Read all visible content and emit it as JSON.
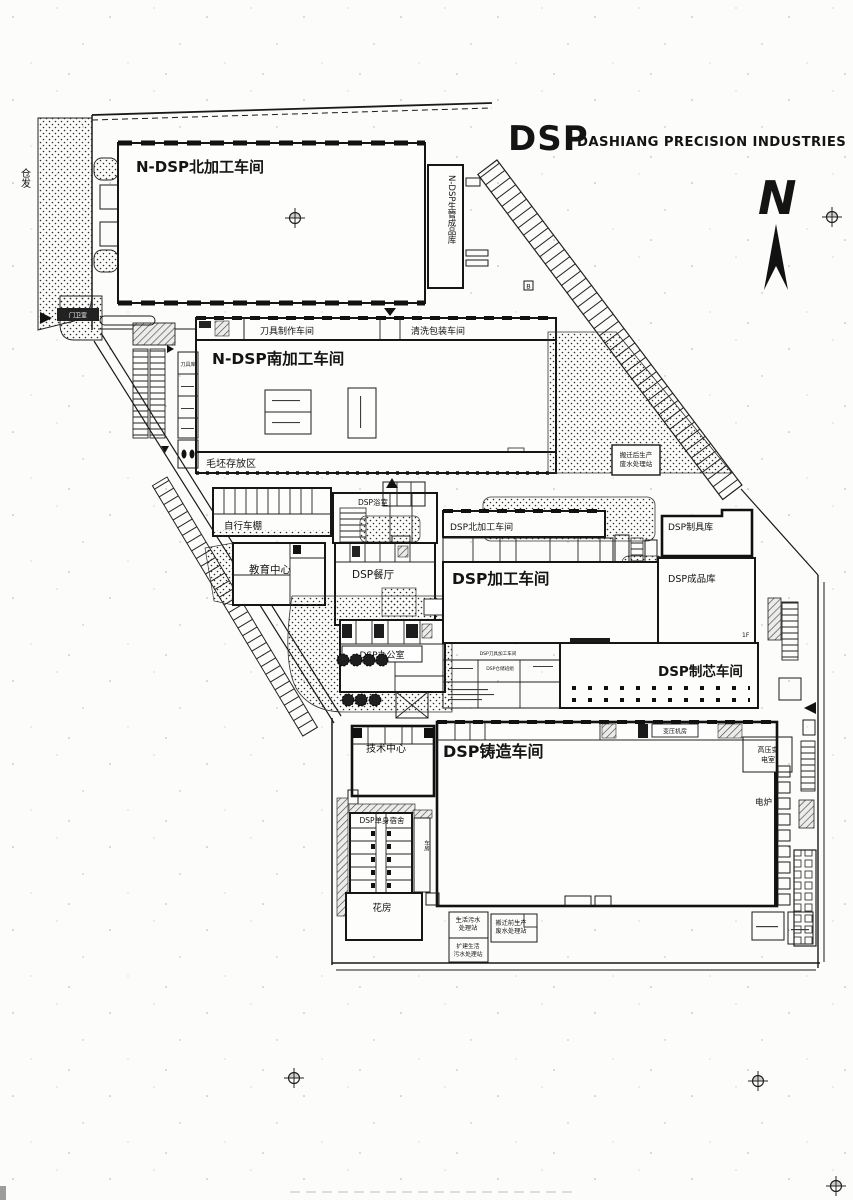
{
  "title": {
    "logo": "DSP",
    "company": "DASHIANG PRECISION INDUSTRIES"
  },
  "compass": {
    "north": "N"
  },
  "annotations": {
    "street": "仓发",
    "marker_b": "B",
    "floor": "1F"
  },
  "north_area": {
    "workshop": "N-DSP北加工车间",
    "warehouse": "N-DSP生管成品库",
    "tool_making": "刀具制作车间",
    "cleaning_packing": "清洗包装车间"
  },
  "south_area": {
    "workshop": "N-DSP南加工车间",
    "blank_storage": "毛坯存放区",
    "tool_store": "刀具库"
  },
  "mid_area": {
    "bike_shed": "自行车棚",
    "bath": "DSP浴室",
    "education": "教育中心",
    "canteen": "DSP餐厅",
    "office": "DSP办公室"
  },
  "plant_area": {
    "north_ws": "DSP北加工车间",
    "tooling": "DSP制具库",
    "machining": "DSP加工车间",
    "finished": "DSP成品库",
    "core": "DSP制芯车间",
    "tool_machining": "DSP刀具加工车间",
    "storage": "DSP仓储班组"
  },
  "foundry_area": {
    "tech": "技术中心",
    "foundry": "DSP铸造车间",
    "transformer": "变压机房",
    "hv1": "高压变",
    "hv2": "电室",
    "furnace": "电炉",
    "dorm": "DSP单身宿舍",
    "garage": "车房",
    "greenhouse": "花房"
  },
  "stations": {
    "post1": "搬迁后生产",
    "post2": "废水处理站",
    "dom1": "生活污水",
    "dom2": "处理站",
    "exp1": "扩建生活",
    "exp2": "污水处理站",
    "pre1": "搬迁前生产",
    "pre2": "废水处理站"
  },
  "gate": {
    "guard": "门卫室"
  }
}
